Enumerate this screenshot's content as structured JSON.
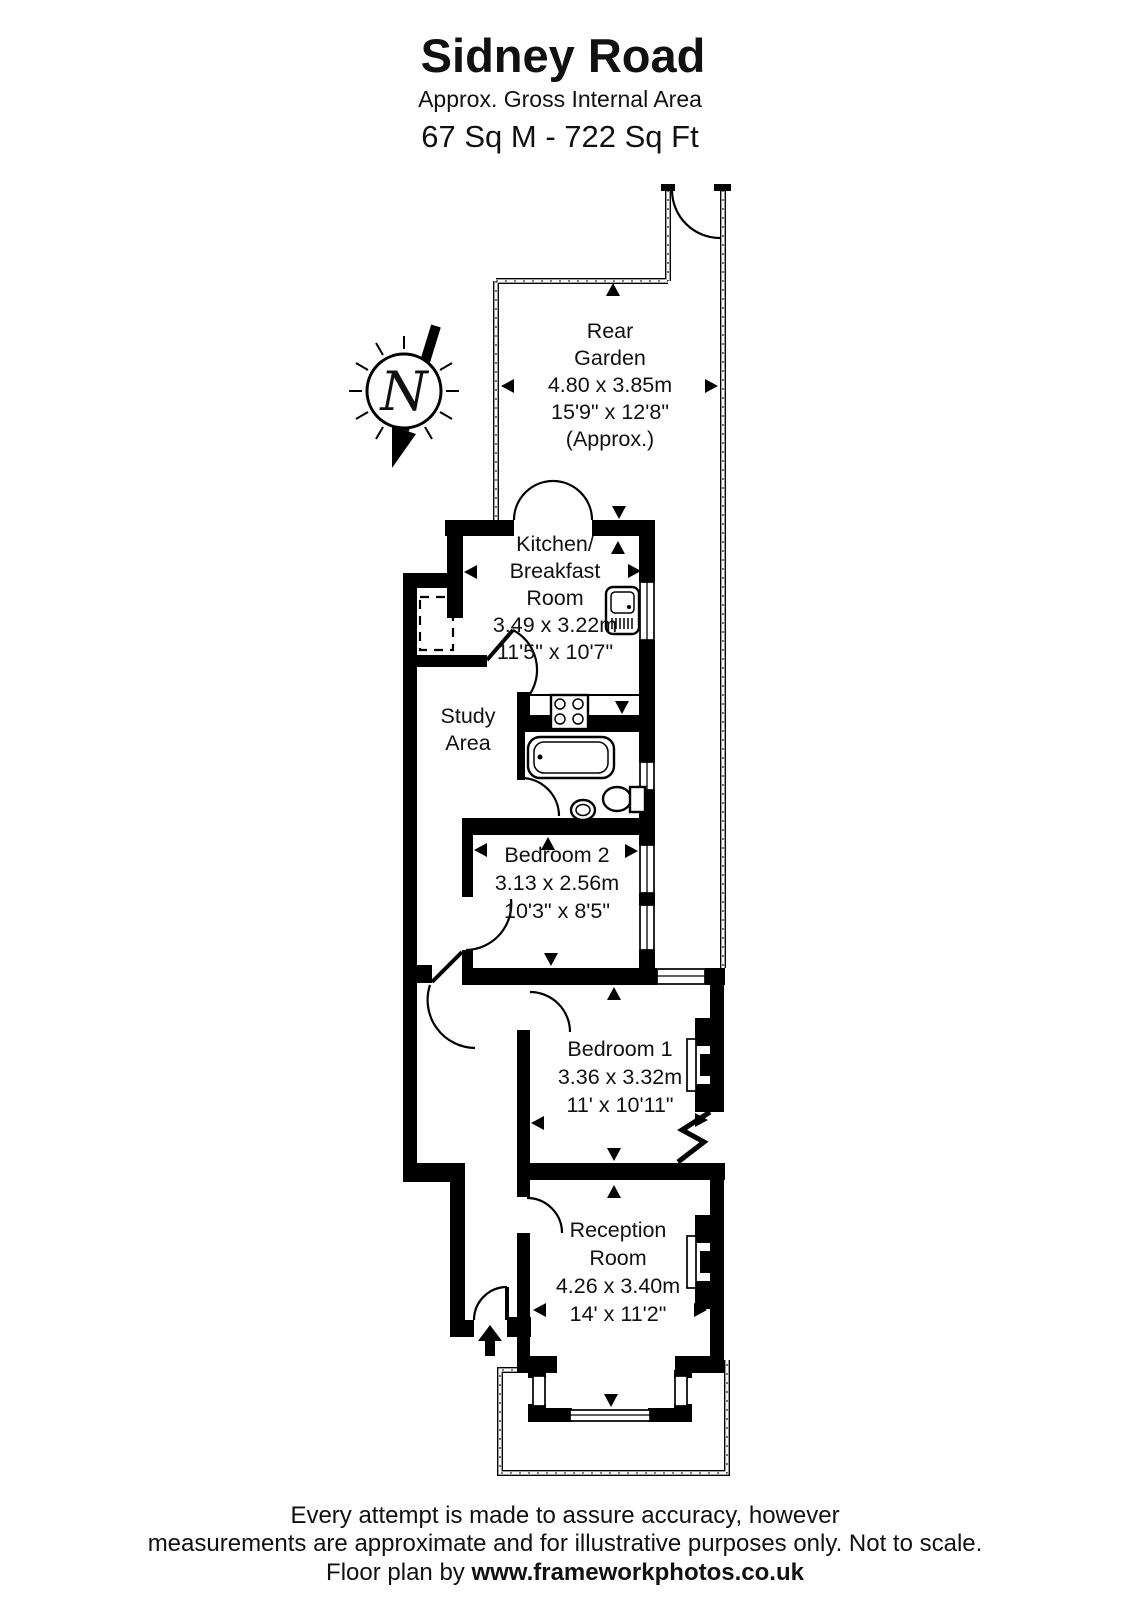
{
  "title": {
    "name": "Sidney Road",
    "subtitle": "Approx. Gross Internal Area",
    "area": "67 Sq M  -  722 Sq Ft"
  },
  "compass": {
    "label": "N"
  },
  "rooms": {
    "rear_garden": {
      "line1": "Rear",
      "line2": "Garden",
      "dims_m": "4.80 x 3.85m",
      "dims_ft": "15'9\" x 12'8\"",
      "approx": "(Approx.)"
    },
    "kitchen": {
      "line1": "Kitchen/",
      "line2": "Breakfast",
      "line3": "Room",
      "dims_m": "3.49 x 3.22m",
      "dims_ft": "11'5\" x 10'7\""
    },
    "study": {
      "line1": "Study",
      "line2": "Area"
    },
    "bedroom2": {
      "name": "Bedroom 2",
      "dims_m": "3.13 x 2.56m",
      "dims_ft": "10'3\" x 8'5\""
    },
    "bedroom1": {
      "name": "Bedroom 1",
      "dims_m": "3.36 x 3.32m",
      "dims_ft": "11' x 10'11\""
    },
    "reception": {
      "line1": "Reception",
      "line2": "Room",
      "dims_m": "4.26 x 3.40m",
      "dims_ft": "14' x 11'2\""
    }
  },
  "footer": {
    "line1": "Every attempt is made to assure accuracy, however",
    "line2": "measurements are approximate and for illustrative purposes only. Not to scale.",
    "line3_prefix": "Floor plan by  ",
    "line3_url": "www.frameworkphotos.co.uk"
  },
  "colors": {
    "wall": "#000000",
    "background": "#ffffff"
  }
}
